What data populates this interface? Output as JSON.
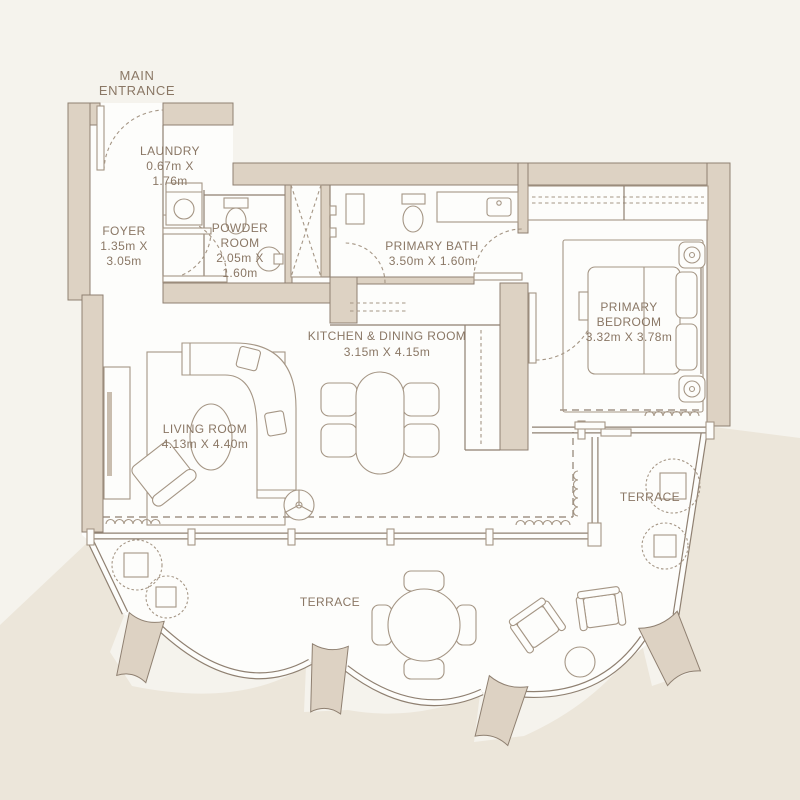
{
  "palette": {
    "bg": "#f5f3ed",
    "outside": "#ece6da",
    "wall": "#ddd2c3",
    "wall_line": "#8f8071",
    "furn_line": "#a59685",
    "text": "#8a7765",
    "white": "#fdfdfb",
    "tv": "#c9bdae"
  },
  "labels": {
    "main_entrance_1": "MAIN",
    "main_entrance_2": "ENTRANCE",
    "terrace_main": "TERRACE",
    "terrace_right": "TERRACE"
  },
  "rooms": {
    "laundry": {
      "name": "LAUNDRY",
      "dim1": "0.67m X",
      "dim2": "1.76m"
    },
    "foyer": {
      "name": "FOYER",
      "dim1": "1.35m X",
      "dim2": "3.05m"
    },
    "powder": {
      "name1": "POWDER",
      "name2": "ROOM",
      "dim1": "2.05m X",
      "dim2": "1.60m"
    },
    "primary_bath": {
      "name": "PRIMARY BATH",
      "dims": "3.50m X 1.60m"
    },
    "primary_bedroom": {
      "name1": "PRIMARY",
      "name2": "BEDROOM",
      "dims": "3.32m X 3.78m"
    },
    "kitchen_dining": {
      "name": "KITCHEN & DINING ROOM",
      "dims": "3.15m X 4.15m"
    },
    "living": {
      "name": "LIVING ROOM",
      "dims": "4.13m X 4.40m"
    }
  }
}
